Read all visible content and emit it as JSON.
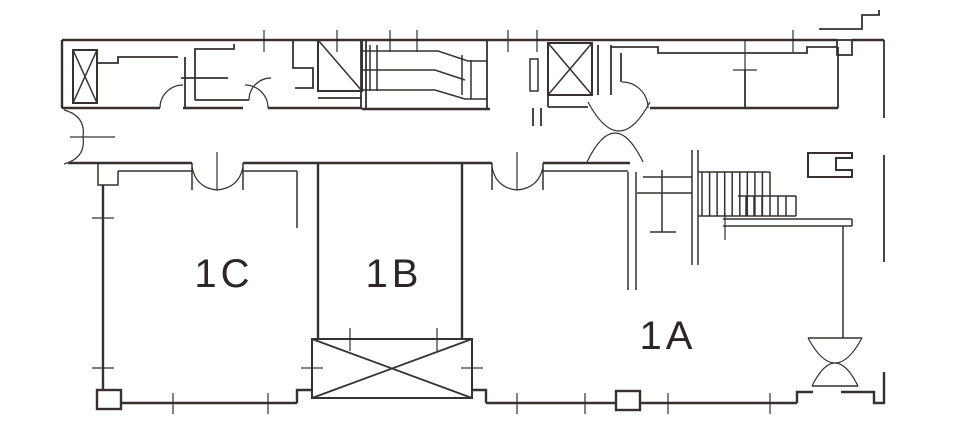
{
  "plan": {
    "rooms": [
      {
        "id": "1c",
        "label": "1C"
      },
      {
        "id": "1b",
        "label": "1B"
      },
      {
        "id": "1a",
        "label": "1A"
      }
    ]
  },
  "colors": {
    "line": "#37302e",
    "label": "#2e2527",
    "background": "#ffffff"
  },
  "icons": [
    "elevator-x-icon",
    "stair-diagonal-icon",
    "escalator-icon",
    "staircase-treads-icon",
    "double-swing-door-icon",
    "door-arc-icon",
    "column-icon",
    "cross-braced-shaft-icon"
  ]
}
